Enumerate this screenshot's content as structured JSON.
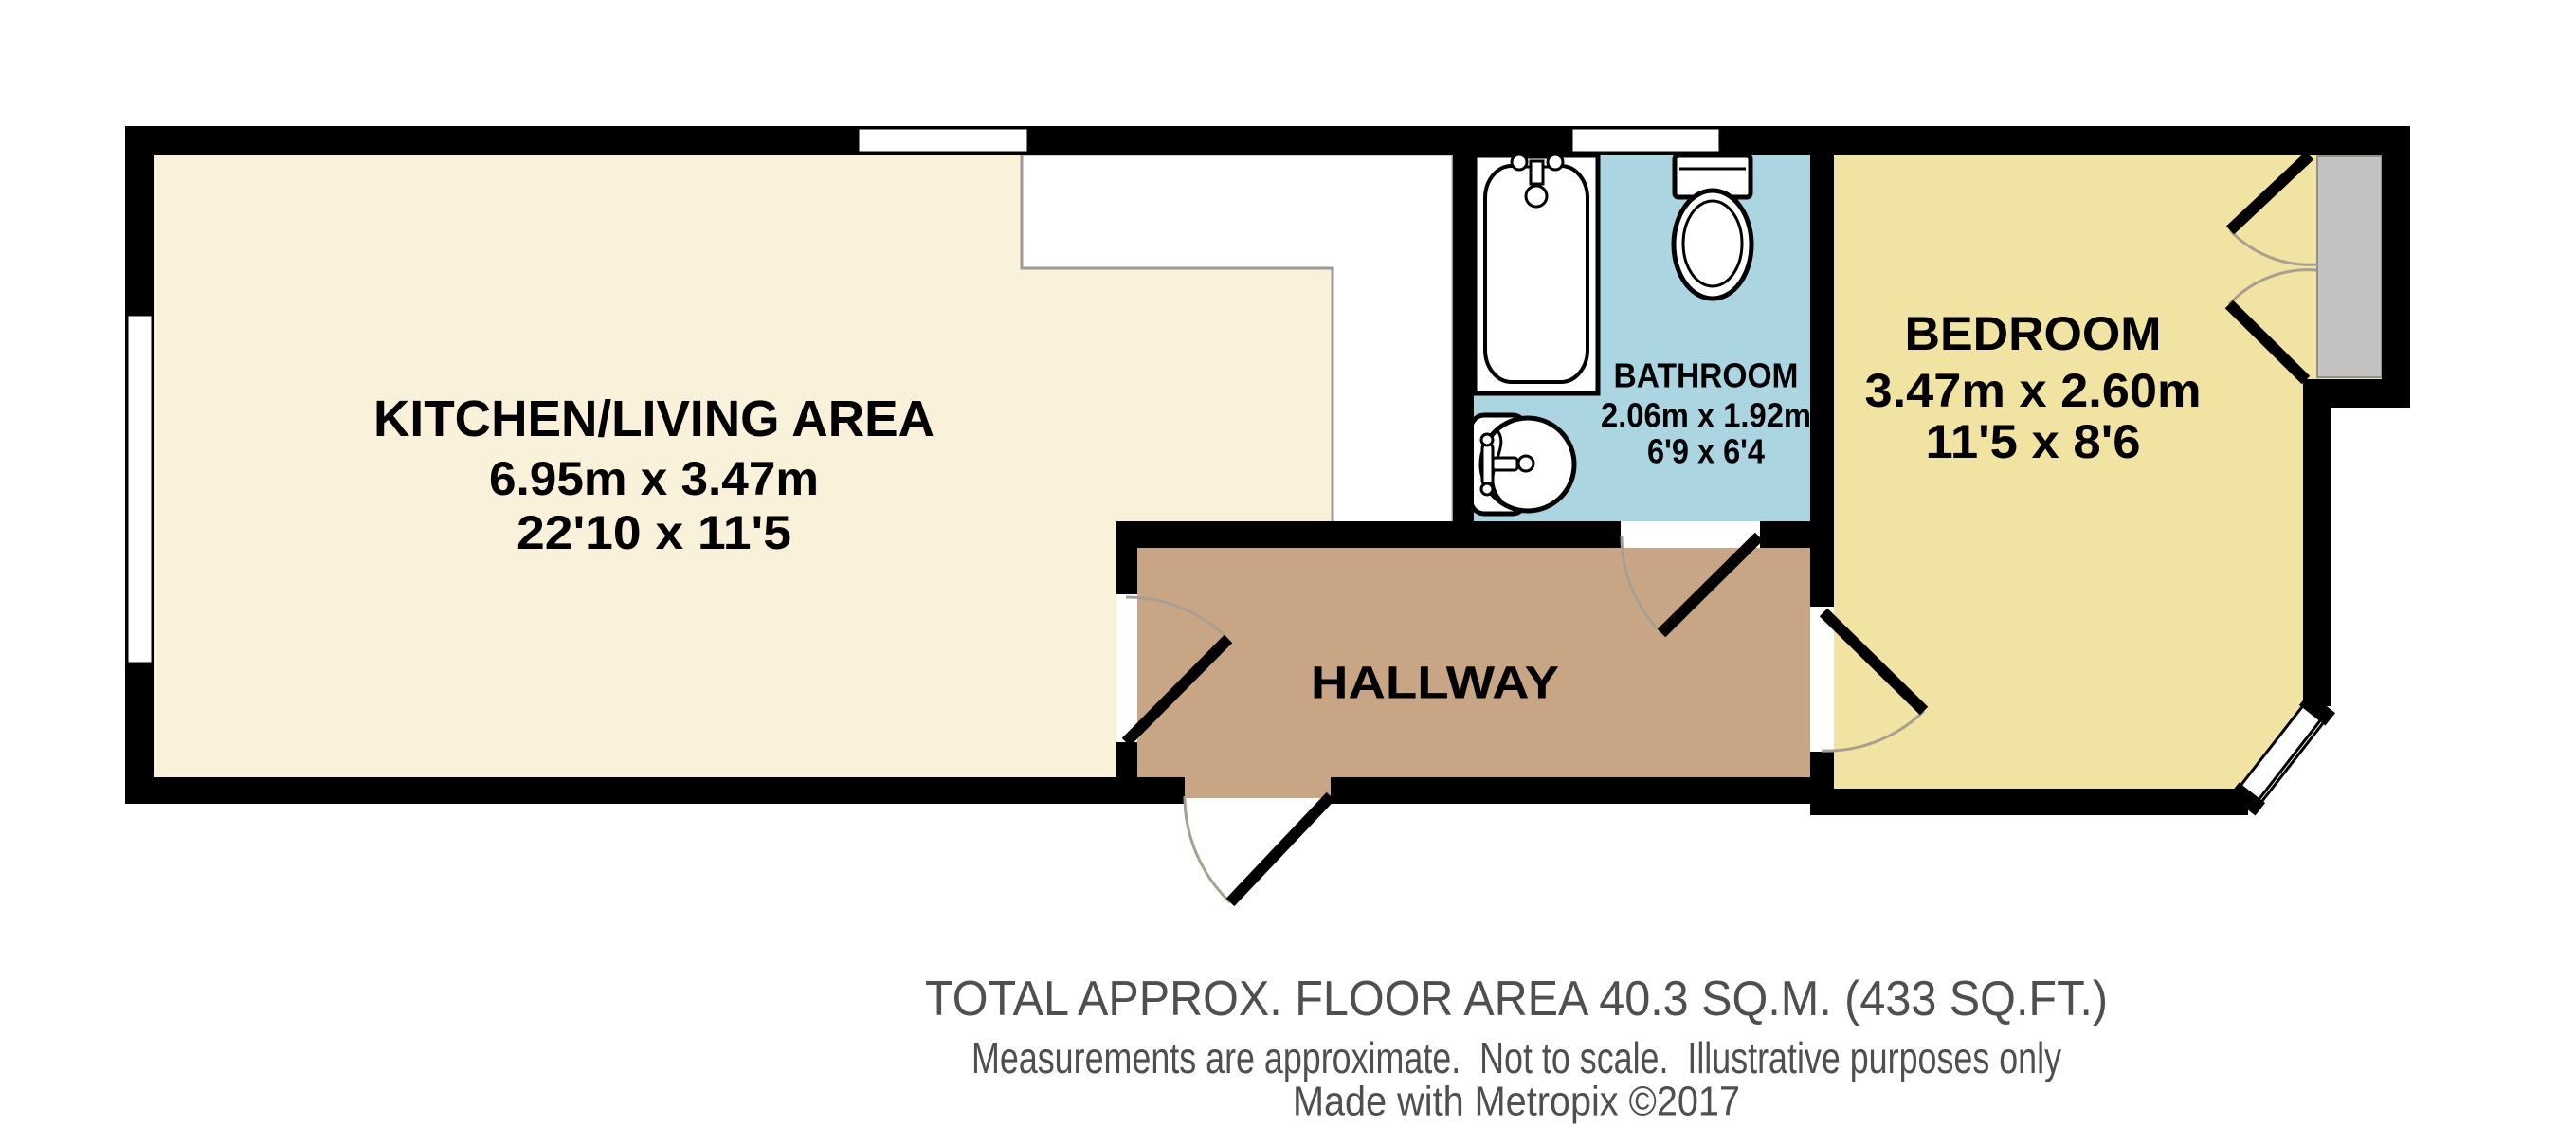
{
  "rooms": {
    "kitchen_living": {
      "label": "KITCHEN/LIVING AREA",
      "metric": "6.95m x 3.47m",
      "imperial": "22'10 x 11'5"
    },
    "bathroom": {
      "label": "BATHROOM",
      "metric": "2.06m x 1.92m",
      "imperial": "6'9 x 6'4"
    },
    "bedroom": {
      "label": "BEDROOM",
      "metric": "3.47m x 2.60m",
      "imperial": "11'5 x 8'6"
    },
    "hallway": {
      "label": "HALLWAY"
    }
  },
  "footer": {
    "total_area": "TOTAL APPROX. FLOOR AREA 40.3 SQ.M. (433 SQ.FT.)",
    "disclaimer": "Measurements are approximate.  Not to scale.  Illustrative purposes only",
    "credit": "Made with Metropix ©2017"
  },
  "colors": {
    "kitchen_floor": "#FAF1DB",
    "bathroom_floor": "#AAD5E1",
    "bedroom_floor": "#F1E3A1",
    "hallway_floor": "#C8A685",
    "counter_white": "#FFFFFF",
    "wall": "#000000",
    "glass_panel_gray": "#C2C2C2",
    "swing_arc": "#A89F92",
    "footer_text": "#4F4F4F"
  }
}
